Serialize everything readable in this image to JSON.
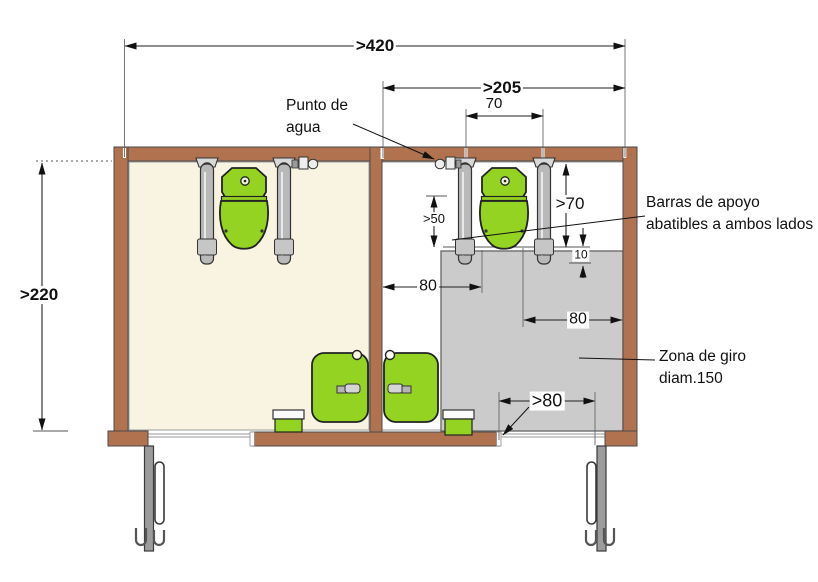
{
  "figure": {
    "kind": "accessible-toilet-floor-plan",
    "dimensions": {
      "total_width": ">420",
      "cabin_width": ">205",
      "bar_axis_spacing": "70",
      "total_depth": ">220",
      "bar_front_clearance": ">50",
      "bar_length": ">70",
      "gap_bar_to_zone": "10",
      "wall_to_toilet_axis": "80",
      "toilet_axis_to_wall": "80",
      "door_clear_width": ">80"
    },
    "labels": {
      "water_point": "Punto de agua",
      "grab_bars": "Barras de apoyo abatibles a ambos lados",
      "turning_zone": "Zona de giro diam.150"
    },
    "colors": {
      "wall": "#b1734f",
      "floor_left_cabin": "#f8f4e1",
      "floor_right_cabin": "#ffffff",
      "turning_zone": "#cbcbcb",
      "fixtures_green": "#94d321",
      "door": "#9c9c9c"
    }
  }
}
